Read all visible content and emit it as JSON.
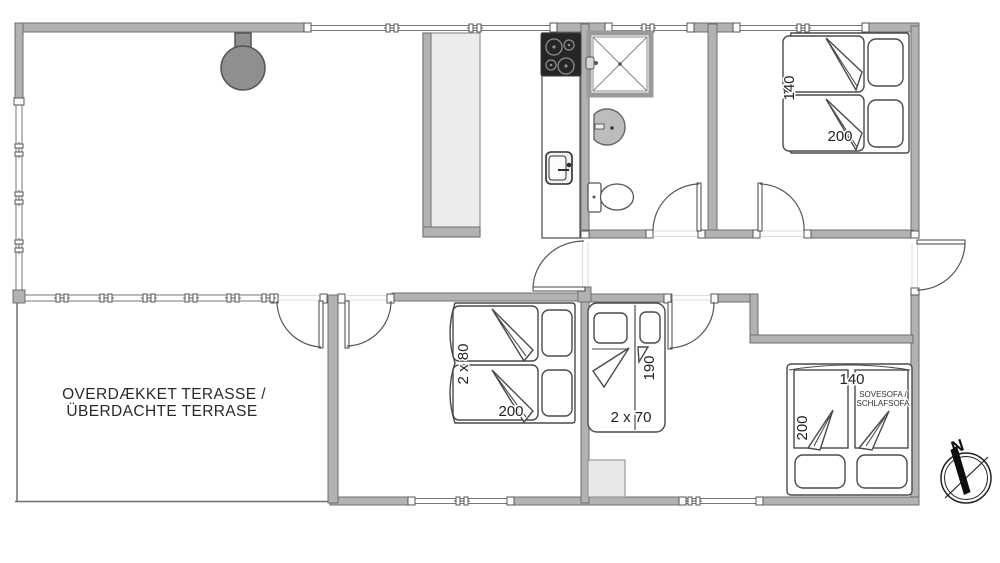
{
  "floor_plan": {
    "type": "holiday-house-floor-plan",
    "terrace": {
      "label_line1": "OVERDÆKKET TERASSE /",
      "label_line2": "ÜBERDACHTE TERRASE"
    },
    "bedroom_top_right": {
      "bed_width": "140",
      "bed_length": "200"
    },
    "bedroom_bottom_left": {
      "bed_width": "2 x 80",
      "bed_length": "200"
    },
    "bunk_room": {
      "bed_length": "190",
      "bed_width": "2 x 70"
    },
    "sofa_room": {
      "bed_width": "140",
      "bed_length": "200",
      "sofa_label_line1": "SOVESOFA /",
      "sofa_label_line2": "SCHLAFSOFA"
    },
    "compass": {
      "north_label": "N"
    },
    "colors": {
      "wall_fill": "#b2b2b2",
      "wall_stroke": "#6f6f6f",
      "furniture_stroke": "#4a4a4a",
      "cooktop": "#262626",
      "fixture_gray": "#bdbdbd",
      "partition_fill": "#ececec",
      "stove_fill": "#8f8f8f",
      "text": "#222222"
    }
  }
}
